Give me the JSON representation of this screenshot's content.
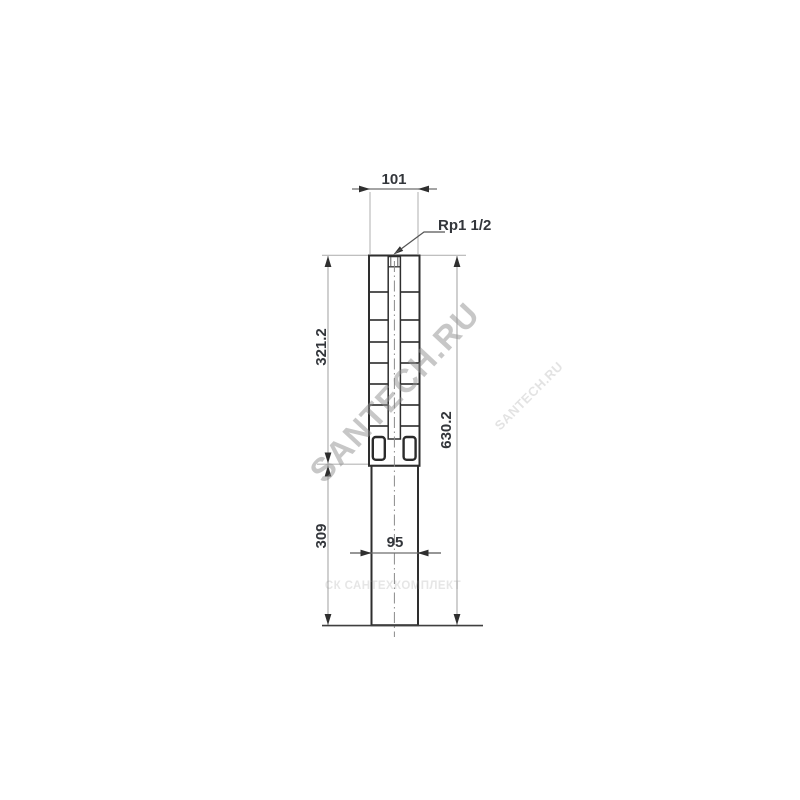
{
  "drawing": {
    "dimensions": {
      "top_width": "101",
      "port_thread": "Rp1 1/2",
      "pump_section_length": "321.2",
      "motor_section_length": "309",
      "overall_length": "630.2",
      "motor_width": "95"
    },
    "watermarks": {
      "large_diagonal": "SANTECH.RU",
      "small_diagonal": "SANTECH.RU",
      "bottom_horizontal": "СК САНТЕХКОМПЛЕКТ"
    },
    "colors": {
      "background": "#ffffff",
      "body_outline": "#2e2e2e",
      "stage_line": "#3d3d3d",
      "dimension_text": "#33363b",
      "dimension_line": "#9a9a9a",
      "extension_line": "#b6b6b6",
      "arrow": "#2f2f2f",
      "centerline": "#8a8a8a",
      "watermark_large": "#8f8f8f",
      "watermark_small": "#9a9a9a",
      "watermark_bottom": "#8f8f8f"
    }
  }
}
